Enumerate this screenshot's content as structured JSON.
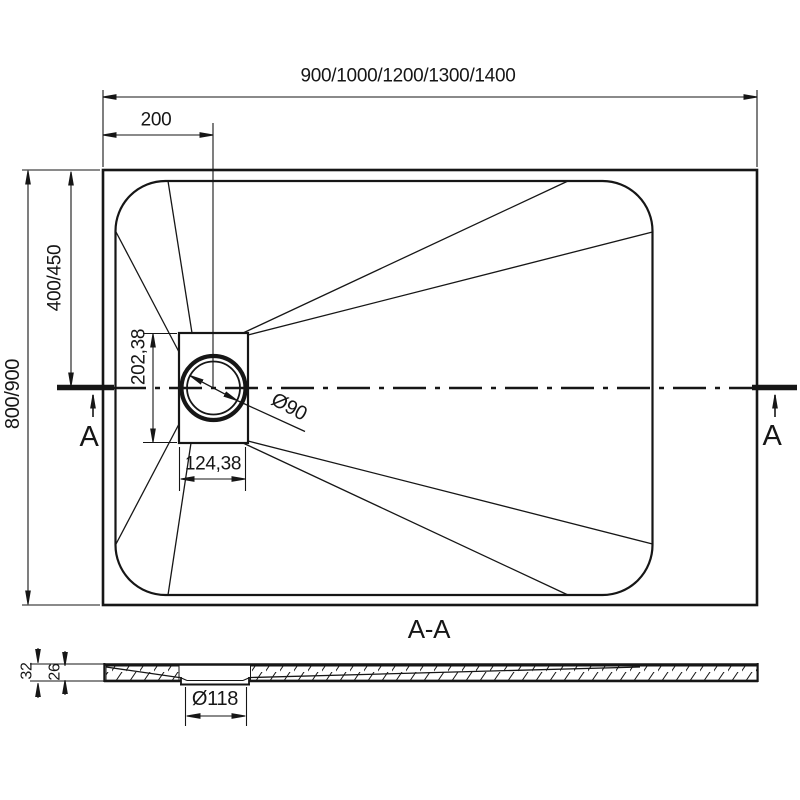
{
  "top_view": {
    "length_dim": "900/1000/1200/1300/1400",
    "drain_offset_dim": "200",
    "width_dim": "800/900",
    "drain_center_from_top_dim": "400/450",
    "drain_box_height_dim": "202,38",
    "drain_box_width_dim": "124,38",
    "drain_diameter": "Ø90",
    "section_marker_left": "A",
    "section_marker_right": "A"
  },
  "section_view": {
    "title": "A-A",
    "total_height_dim": "32",
    "base_height_dim": "26",
    "drain_recess_diameter": "Ø118"
  },
  "colors": {
    "line": "#161616",
    "background": "#ffffff"
  }
}
